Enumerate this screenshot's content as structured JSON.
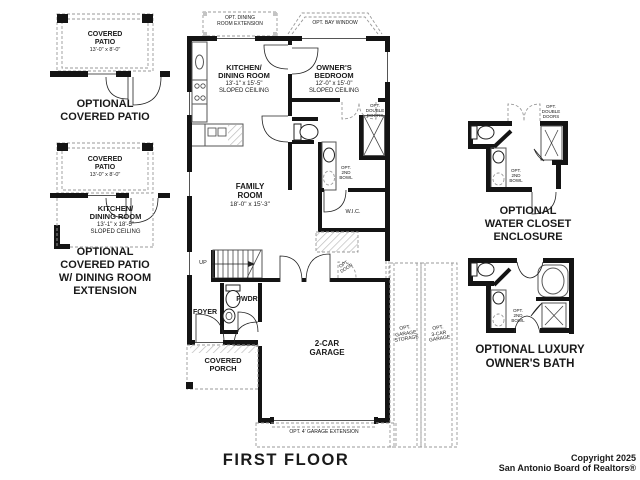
{
  "title": "FIRST FLOOR",
  "copyright": {
    "line1": "Copyright 2025",
    "line2": "San Antonio Board of Realtors®"
  },
  "common": {
    "opt_2nd_bowl": {
      "l1": "OPT.",
      "l2": "2ND",
      "l3": "BOWL"
    },
    "opt_double_doors": {
      "l1": "OPT.",
      "l2": "DOUBLE",
      "l3": "DOORS"
    },
    "covered_patio": {
      "l1": "COVERED",
      "l2": "PATIO",
      "dims": "13'-0\" x 8'-0\""
    }
  },
  "left_top": {
    "caption1": "OPTIONAL",
    "caption2": "COVERED PATIO"
  },
  "left_mid": {
    "kitchen": {
      "l1": "KITCHEN/",
      "l2": "DINING ROOM",
      "dims": "13'-1\" x 18'-5\"",
      "ceiling": "SLOPED CEILING"
    },
    "caption1": "OPTIONAL",
    "caption2": "COVERED PATIO",
    "caption3": "W/ DINING ROOM",
    "caption4": "EXTENSION"
  },
  "main": {
    "opt_dining_ext": {
      "l1": "OPT. DINING",
      "l2": "ROOM EXTENSION"
    },
    "opt_bay_window": "OPT. BAY WINDOW",
    "kitchen": {
      "l1": "KITCHEN/",
      "l2": "DINING ROOM",
      "dims": "13'-1\" x 15'-5\"",
      "ceiling": "SLOPED CEILING"
    },
    "bedroom": {
      "l1": "OWNER'S",
      "l2": "BEDROOM",
      "dims": "12'-0\" x 15'-0\"",
      "ceiling": "SLOPED CEILING"
    },
    "family": {
      "l1": "FAMILY",
      "l2": "ROOM",
      "dims": "18'-0\" x 15'-3\""
    },
    "wic": "W.I.C.",
    "up": "UP",
    "opt_door": {
      "l1": "OPT.",
      "l2": "DOOR"
    },
    "pwdr": "PWDR",
    "foyer": "FOYER",
    "porch": {
      "l1": "COVERED",
      "l2": "PORCH"
    },
    "garage": {
      "l1": "2-CAR",
      "l2": "GARAGE"
    },
    "opt_garage_storage": {
      "l1": "OPT.",
      "l2": "GARAGE",
      "l3": "STORAGE"
    },
    "opt_3car_garage": {
      "l1": "OPT.",
      "l2": "3-CAR",
      "l3": "GARAGE"
    },
    "opt_garage_ext": "OPT. 4' GARAGE EXTENSION"
  },
  "right_top": {
    "caption1": "OPTIONAL",
    "caption2": "WATER CLOSET",
    "caption3": "ENCLOSURE"
  },
  "right_bottom": {
    "caption1": "OPTIONAL LUXURY",
    "caption2": "OWNER'S BATH"
  },
  "colors": {
    "wall": "#141414",
    "dashed": "#999999",
    "text": "#1a1a1a",
    "bg": "#ffffff"
  }
}
